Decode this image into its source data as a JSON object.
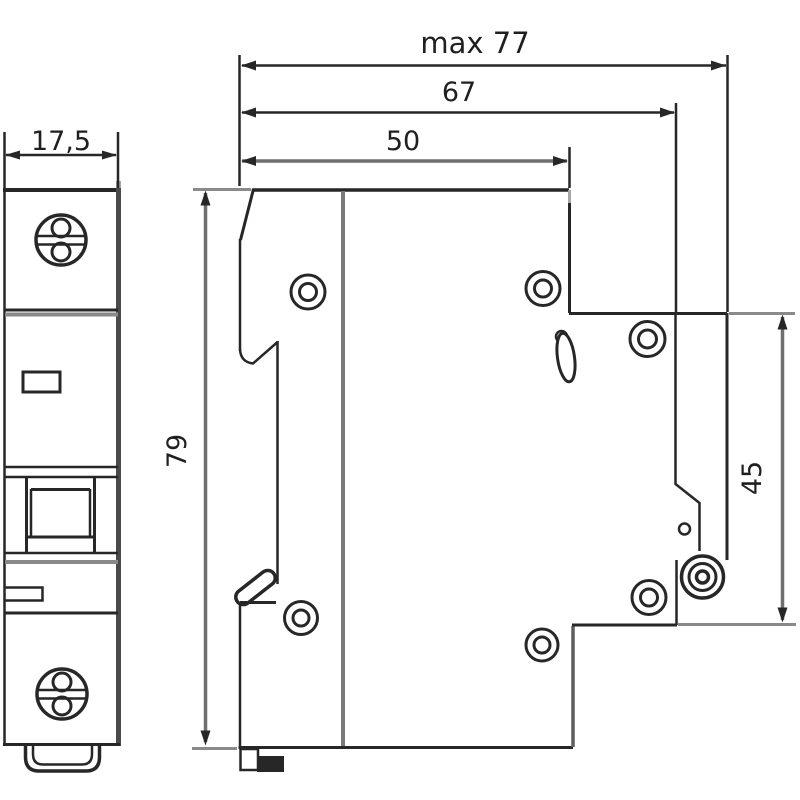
{
  "colors": {
    "background": "#ffffff",
    "line_dark": "#272727",
    "line_medium": "#4a4a4a",
    "line_gray": "#6f6f6f",
    "line_light": "#8a8a8a"
  },
  "dimensions": {
    "front_width": "17,5",
    "overall_depth": "max 77",
    "depth_with_terminal": "67",
    "body_depth": "50",
    "height": "79",
    "din_rail_height": "45"
  }
}
